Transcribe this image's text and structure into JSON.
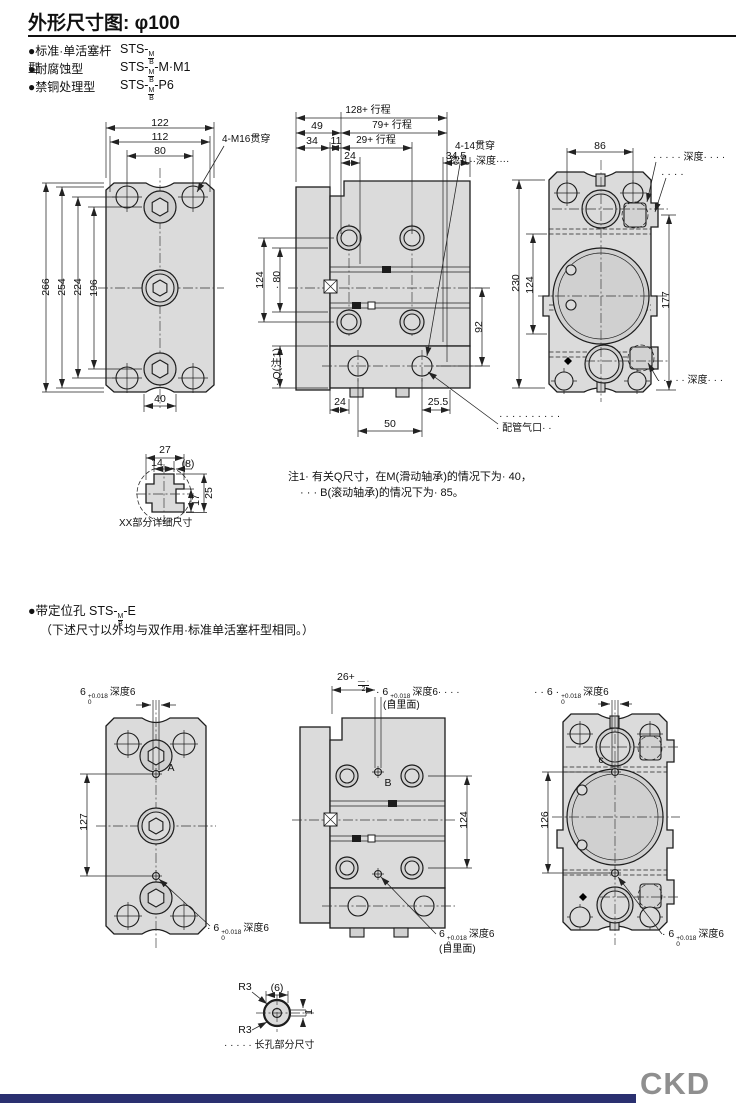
{
  "page": {
    "title": "外形尺寸图: φ100"
  },
  "models": [
    {
      "label": "●标准·单活塞杆型",
      "pre": "STS-",
      "top": "M",
      "bot": "B",
      "post": ""
    },
    {
      "label": "●耐腐蚀型",
      "pre": "STS-",
      "top": "M",
      "bot": "B",
      "post": "-M·M1"
    },
    {
      "label": "●禁铜处理型",
      "pre": "STS-",
      "top": "M",
      "bot": "B",
      "post": "-P6"
    }
  ],
  "sec1": {
    "front": {
      "d122": "122",
      "d112": "112",
      "d80": "80",
      "lead": "4-M16贯穿",
      "v266": "266",
      "v254": "254",
      "v224": "224",
      "v196": "196",
      "b40": "40"
    },
    "detail": {
      "d27": "27",
      "d14": "14",
      "d8": "(8)",
      "d17": "17",
      "d25": "25",
      "caption": "XX部分详细尺寸"
    },
    "side": {
      "t128": "128+ 行程",
      "t49": "49",
      "t79": "79+ 行程",
      "t34": "34",
      "t11": "11",
      "t29": "29+ 行程",
      "t24": "24",
      "t345": "34.5",
      "lead1": "4-14贯穿",
      "lead2": "·锪孔··深度····",
      "l124": "124",
      "l80": "· 80",
      "lq": "· Q(注1)",
      "r92": "92",
      "b24": "24",
      "b50": "50",
      "b255": "25.5",
      "portdots": "· · · · · · · · · ·",
      "port": "· 配管气口· ·"
    },
    "end": {
      "t86": "86",
      "leadt1": "· · · · · 深度· · · ·",
      "leadt2": "· · · ·",
      "l230": "230",
      "l124": "124",
      "r177": "177",
      "leadb": "· · · · · 深度· · ·"
    },
    "note1": "注1· 有关Q尺寸，在M(滑动轴承)的情况下为· 40，",
    "note2": "· · · B(滚动轴承)的情况下为· 85。"
  },
  "sec2": {
    "header": {
      "pre": "●带定位孔 STS-",
      "top": "M",
      "bot": "B",
      "post": "-E",
      "line2": "（下述尺寸以外均与双作用·标准单活塞杆型相同。）"
    },
    "tol": {
      "sup": "+0.018",
      "sub": "0"
    },
    "front": {
      "tpre": "6",
      "tsuf": "深度6",
      "markA": "A",
      "v127": "127",
      "bpre": "· 6",
      "bsuf": "深度6"
    },
    "side": {
      "t26": "26+",
      "ftop": "— ·",
      "fbot": "2",
      "mpre": "· 6",
      "msuf": "深度6· · · ·",
      "inner": "(自里面)",
      "markB": "B",
      "r124": "124",
      "bpre": "6",
      "bsuf": "深度6",
      "inner2": "(自里面)"
    },
    "end": {
      "tpre": "· · 6 ·",
      "tsuf": "深度6",
      "markC": "c",
      "l126": "126",
      "bpre": "· 6",
      "bsuf": "深度6"
    },
    "slot": {
      "r3a": "R3",
      "r3b": "R3",
      "d6": "(6)",
      "d1": "1",
      "caption": "· · · · · 长孔部分尺寸"
    }
  },
  "footer": {
    "logo": "CKD"
  }
}
